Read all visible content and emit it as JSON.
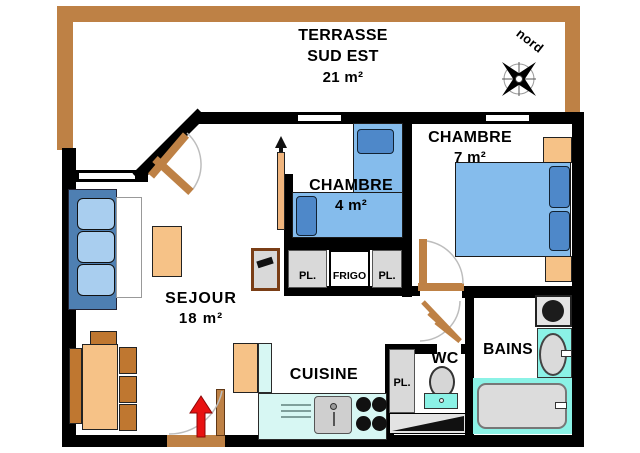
{
  "plan": {
    "title": "apartment floor plan",
    "terrace": {
      "name": "TERRASSE",
      "orientation": "SUD EST",
      "area": "21 m²"
    },
    "compass": {
      "label": "nord"
    },
    "rooms": {
      "sejour": {
        "name": "SEJOUR",
        "area": "18 m²"
      },
      "chambre4": {
        "name": "CHAMBRE",
        "area": "4 m²"
      },
      "chambre7": {
        "name": "CHAMBRE",
        "area": "7 m²"
      },
      "cuisine": {
        "name": "CUISINE"
      },
      "wc": {
        "name": "WC"
      },
      "bains": {
        "name": "BAINS"
      }
    },
    "closets": {
      "pl_left": "PL.",
      "frigo": "FRIGO",
      "pl_right": "PL.",
      "pl_wc": "PL."
    },
    "colors": {
      "wall": "#000000",
      "wood_trim": "#BE8145",
      "furniture_tan": "#F6C287",
      "chair_brown": "#BF7730",
      "bed_blue": "#85BCEC",
      "pillow_blue": "#4E88C9",
      "sofa_frame_blue": "#4E7FB2",
      "sofa_cushion_blue": "#A9CEEF",
      "fixture_cyan": "#8BF2E6",
      "counter_cyan": "#D7F7F3",
      "closet_gray": "#D9D9D9",
      "entry_arrow_red": "#E81212"
    }
  }
}
